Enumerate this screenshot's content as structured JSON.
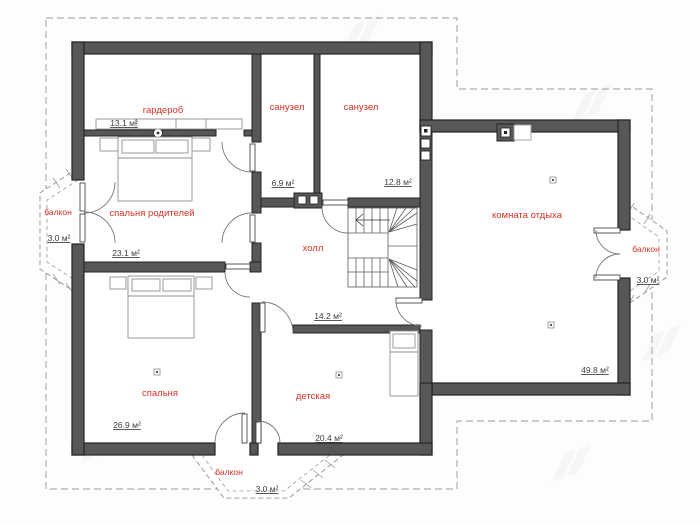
{
  "colors": {
    "room_label": "#d63226",
    "area_label": "#3d3d3d",
    "wall": "#575757",
    "wall_edge": "#232323",
    "roof_dash": "#b0b0b0",
    "balcony_dash": "#9b9b9b",
    "furniture": "#8f8f8f"
  },
  "rooms": {
    "wardrobe": {
      "label": "гардероб",
      "area": "13.1 м²"
    },
    "bath_small": {
      "label": "санузел",
      "area": "6.9 м²"
    },
    "bath_large": {
      "label": "санузел",
      "area": "12.8 м²"
    },
    "master_bedroom": {
      "label": "спальня родителей",
      "area": "23.1 м²"
    },
    "hall": {
      "label": "холл",
      "area": "14.2 м²"
    },
    "lounge": {
      "label": "комната отдыха",
      "area": "49.8 м²"
    },
    "bedroom": {
      "label": "спальня",
      "area": "26.9 м²"
    },
    "kids_room": {
      "label": "детская",
      "area": "20.4 м²"
    },
    "balcony_left": {
      "label": "балкон",
      "area": "3.0 м²"
    },
    "balcony_right": {
      "label": "балкон",
      "area": "3.0 м²"
    },
    "balcony_bottom": {
      "label": "балкон",
      "area": "3.0 м²"
    }
  }
}
